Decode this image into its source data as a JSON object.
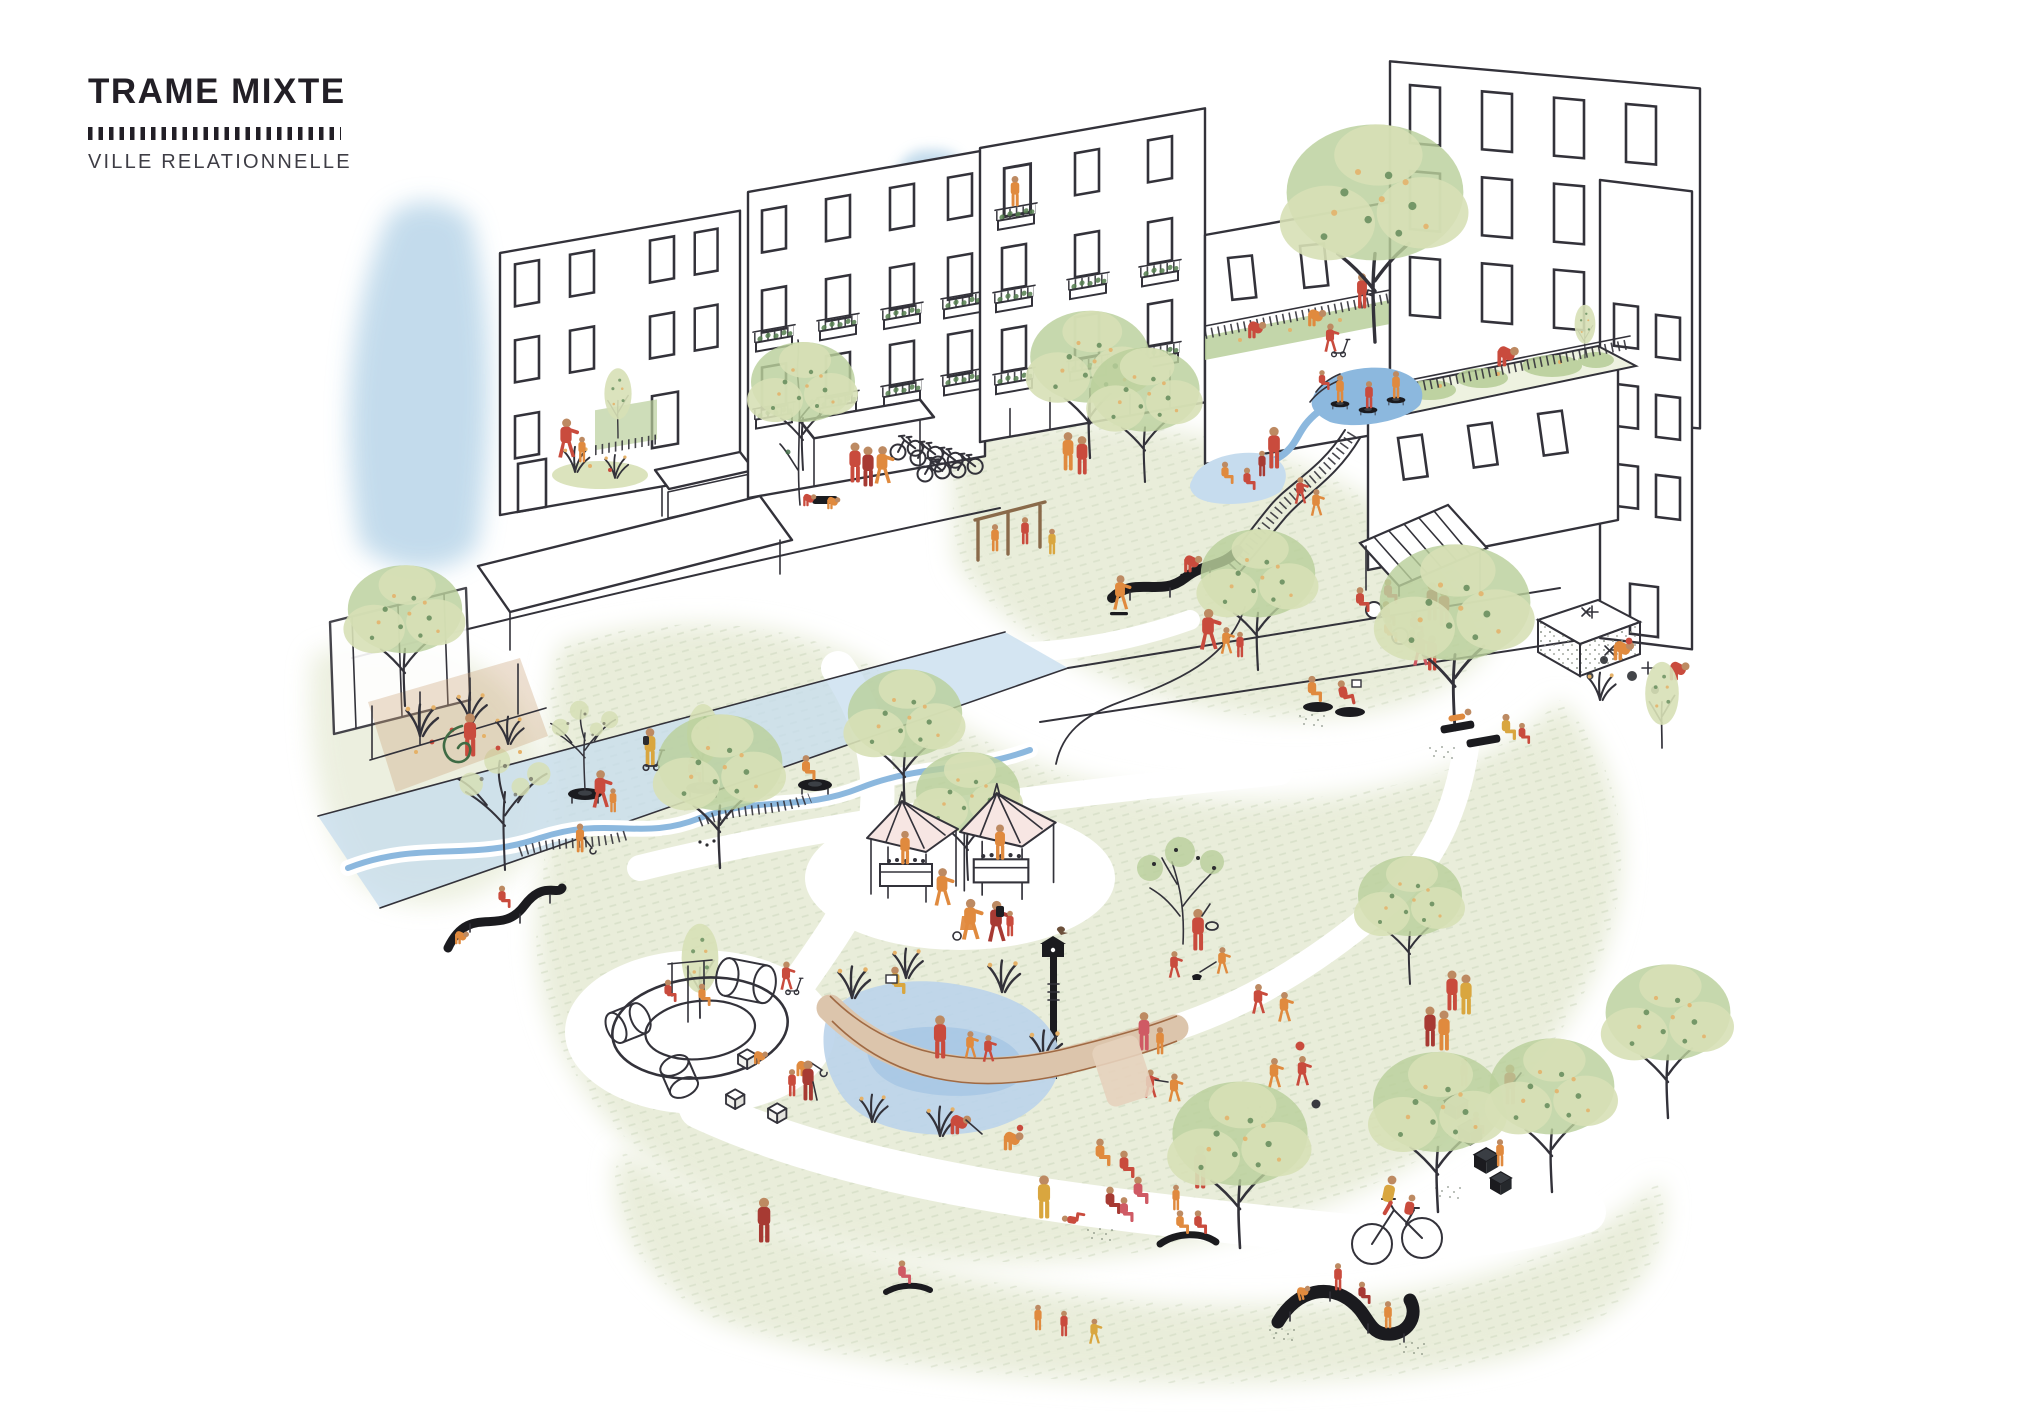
{
  "page": {
    "background": "#ffffff",
    "width": 2040,
    "height": 1414
  },
  "header": {
    "title": "TRAME MIXTE",
    "subtitle": "VILLE RELATIONNELLE"
  },
  "palette": {
    "title_ink": "#221f26",
    "ink": "#33323a",
    "accent_red": "#c94b3d",
    "accent_dark_red": "#a73a33",
    "accent_orange": "#e08a3e",
    "accent_mustard": "#d9a63f",
    "accent_pink_red": "#cf5a64",
    "skin": "#bd8a62",
    "water_strong": "#8cb8de",
    "water_pale": "#c6dcee",
    "wash_blue": "#bdd8ea",
    "foliage_pale": "#d7e0b6",
    "foliage_mid": "#b9cf9b",
    "foliage_dark": "#55804f",
    "speckle_orange": "#e5b168",
    "lawn": "#e9edda",
    "lawn_hatch": "#c9d4ba",
    "boardwalk_tan": "#dcc5ac",
    "boardwalk_edge": "#a06a44",
    "tent_pink": "#f7e6e3",
    "feature_black": "#1b1b1f",
    "gabion_gray": "#b9bdb4"
  }
}
